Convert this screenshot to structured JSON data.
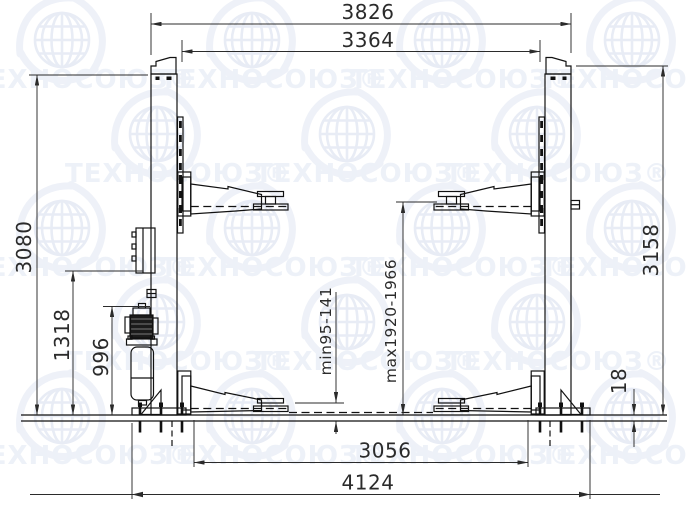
{
  "page": {
    "background": "#ffffff"
  },
  "watermark": {
    "text": "ТЕХНОСОЮЗ",
    "registered_mark": "®",
    "full": "ТЕХНОСОЮЗ®",
    "color": "#edf1f8",
    "globe_color": "#e8ecf5",
    "swirl_color": "#eef1f8"
  },
  "drawing": {
    "type": "two-post automotive lift, front elevation, dimensioned",
    "line_color": "#111111",
    "dim_color": "#2b2b2b",
    "dimensions": {
      "overall_width_top": "3826",
      "inner_width_top": "3364",
      "column_height_left": "3080",
      "control_box_height": "1318",
      "power_unit_height": "996",
      "overall_height_right": "3158",
      "base_thickness": "18",
      "pad_min_height": "min95-141",
      "pad_max_height": "max1920-1966",
      "inner_width_bottom": "3056",
      "overall_width_bottom": "4124"
    }
  }
}
